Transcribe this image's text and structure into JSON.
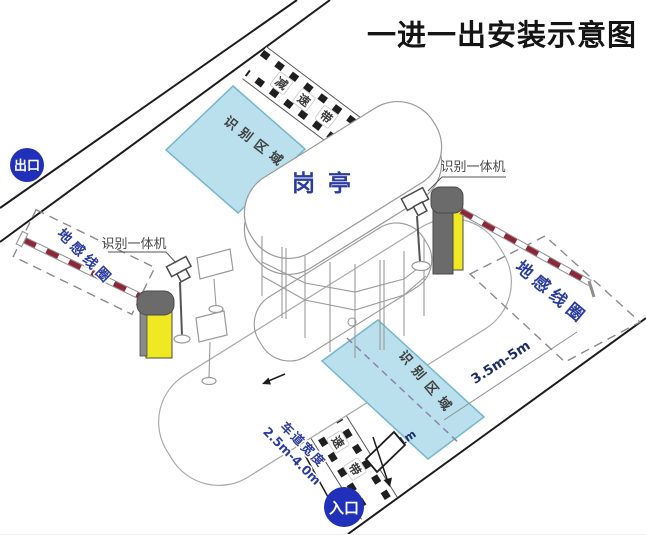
{
  "title": "一进一出安装示意图",
  "badges": {
    "exit": "出口",
    "entrance": "入口"
  },
  "booth": {
    "label": "岗亭"
  },
  "labels": {
    "recognition_area": "识别区域",
    "ground_coil": "地感线圈",
    "reader_machine": "识别一体机"
  },
  "speed_bump": {
    "char1": "减",
    "char2": "速",
    "char3": "带"
  },
  "dimensions": {
    "lane_width_title": "车道宽度",
    "lane_width_value": "2.5m-4.0m",
    "coil_distance": "3.5m-5m",
    "stop_offset": "1m"
  },
  "colors": {
    "badge_background": "#2130b8",
    "badge_text": "#ffffff",
    "recognition_area_fill": "#b9e0ec",
    "recognition_area_border": "#74b7cb",
    "blue_label": "#2b3c9e",
    "dimension_text": "#1f2d66",
    "barrier_arm_red": "#8c2638",
    "machine_yellow": "#f0e822",
    "machine_gray": "#6b6b6b",
    "outline_gray": "#9a9a9a",
    "road_line": "#1c1c1c"
  }
}
